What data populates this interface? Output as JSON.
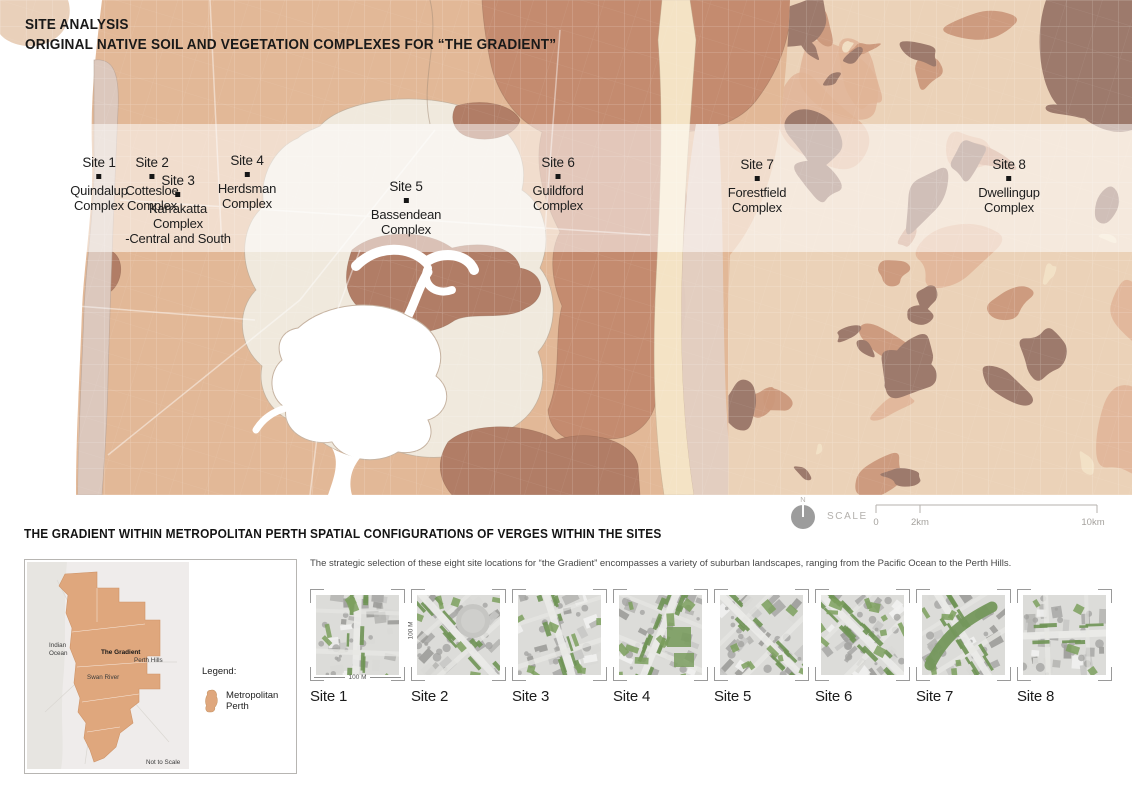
{
  "map": {
    "title_line1": "SITE ANALYSIS",
    "title_line2": "ORIGINAL NATIVE SOIL AND VEGETATION COMPLEXES FOR “THE GRADIENT”",
    "sites": [
      {
        "label": "Site 1",
        "complex_lines": [
          "Quindalup",
          "Complex"
        ]
      },
      {
        "label": "Site 2",
        "complex_lines": [
          "Cottesloe",
          "Complex"
        ]
      },
      {
        "label": "Site 3",
        "complex_lines": [
          "Karrakatta",
          "Complex",
          "-Central and South"
        ]
      },
      {
        "label": "Site 4",
        "complex_lines": [
          "Herdsman",
          "Complex"
        ]
      },
      {
        "label": "Site 5",
        "complex_lines": [
          "Bassendean",
          "Complex"
        ]
      },
      {
        "label": "Site 6",
        "complex_lines": [
          "Guildford",
          "Complex"
        ]
      },
      {
        "label": "Site 7",
        "complex_lines": [
          "Forestfield",
          "Complex"
        ]
      },
      {
        "label": "Site 8",
        "complex_lines": [
          "Dwellingup",
          "Complex"
        ]
      }
    ],
    "colors": {
      "tan": "#e2b897",
      "salmon": "#c48b6f",
      "cream": "#f0e9dd",
      "dark_brown": "#b17d66",
      "hills_base": "#ebd2b8",
      "hills_dark": "#9d7a6c",
      "hills_salmon": "#cb987b",
      "hills_peach": "#e0b496",
      "quindalup": "#dcc8bd",
      "scarp_cream": "#f4e3c5",
      "scarp_pink": "#e3cfc2",
      "river": "#ffffff"
    }
  },
  "scalebar": {
    "north": "N",
    "label": "SCALE",
    "ticks": [
      "0",
      "2km",
      "10km"
    ]
  },
  "inset": {
    "title": "THE GRADIENT WITHIN METROPOLITAN PERTH",
    "labels": {
      "ocean": [
        "Indian",
        "Ocean"
      ],
      "gradient": "The Gradient",
      "hills": "Perth Hills",
      "river": "Swan River",
      "note": "Not to Scale"
    },
    "legend": {
      "title": "Legend:",
      "item": "Metropolitan Perth"
    },
    "metro_color": "#dfa77d"
  },
  "verges": {
    "title": "SPATIAL CONFIGURATIONS OF VERGES WITHIN THE SITES",
    "description": "The strategic selection of these eight site locations for “the Gradient” encompasses a variety of suburban landscapes, ranging from the Pacific Ocean to the Perth Hills.",
    "scale_label": "100 M",
    "sites": [
      "Site 1",
      "Site 2",
      "Site 3",
      "Site 4",
      "Site 5",
      "Site 6",
      "Site 7",
      "Site 8"
    ]
  }
}
